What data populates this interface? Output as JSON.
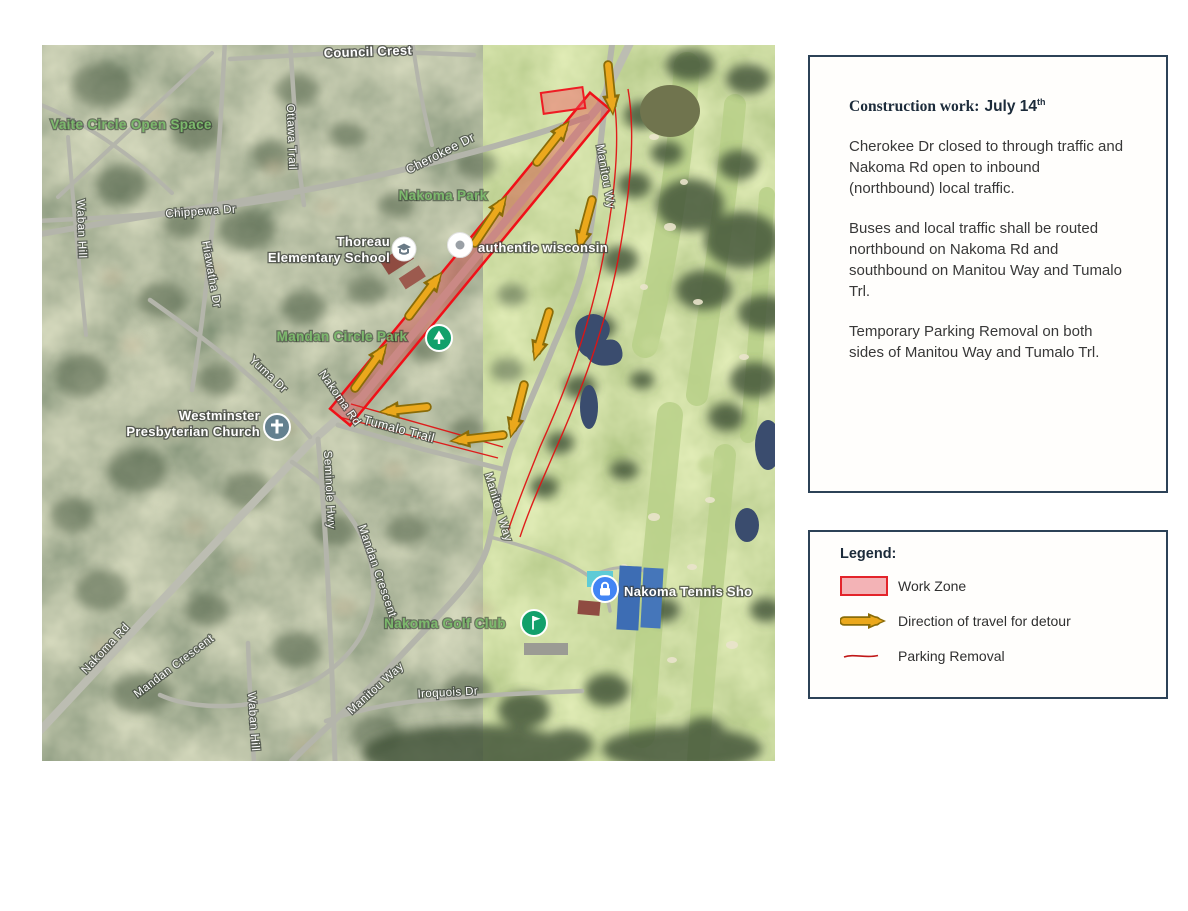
{
  "map": {
    "labels": {
      "council_crest": "Council Crest",
      "vaite_circle": "Vaite Circle Open Space",
      "ottawa_trail": "Ottawa Trail",
      "chippewa_dr": "Chippewa Dr",
      "waban_hill_left": "Waban Hill",
      "hiawatha_dr": "Hiawatha Dr",
      "cherokee_dr": "Cherokee Dr",
      "nakoma_park": "Nakoma Park",
      "thoreau_line1": "Thoreau",
      "thoreau_line2": "Elementary School",
      "authentic_wisconsin": "authentic wisconsin",
      "manitou_way_top": "Manitou Wy",
      "mandan_circle_park": "Mandan Circle Park",
      "yuma_dr": "Yuma Dr",
      "nakoma_rd_mid": "Nakoma Rd",
      "tumalo_trail": "Tumalo Trail",
      "westminster_line1": "Westminster",
      "westminster_line2": "Presbyterian Church",
      "seminole_hwy": "Seminole Hwy",
      "mandan_crescent_right": "Mandan Crescent",
      "mandan_crescent_left": "Mandan Crescent",
      "manitou_way_mid": "Manitou Way",
      "nakoma_golf_club": "Nakoma Golf Club",
      "nakoma_tennis": "Nakoma Tennis Sho",
      "manitou_way_bottom": "Manitou Way",
      "nakoma_rd_bottom": "Nakoma Rd",
      "waban_hill_bottom": "Waban Hill",
      "iroquois_dr": "Iroquois Dr"
    },
    "icons": [
      "school-icon",
      "place-pin-icon",
      "church-icon",
      "park-icon",
      "golf-icon",
      "lock-icon"
    ]
  },
  "info_panel": {
    "title_label": "Construction work:",
    "title_date": "July 14",
    "title_sup": "th",
    "paragraphs": [
      "Cherokee Dr closed to through traffic and Nakoma Rd open to inbound (northbound) local traffic.",
      "Buses and local traffic shall be routed northbound on Nakoma Rd and southbound on Manitou Way and Tumalo Trl.",
      "Temporary Parking Removal on both sides of Manitou Way and Tumalo Trl."
    ]
  },
  "legend": {
    "title": "Legend:",
    "items": [
      {
        "label": "Work Zone",
        "swatch": "work-zone"
      },
      {
        "label": "Direction of travel for detour",
        "swatch": "detour-arrow"
      },
      {
        "label": "Parking Removal",
        "swatch": "parking-line"
      }
    ]
  },
  "colors": {
    "work_zone_fill": "#f3b3b6",
    "work_zone_border": "#e3242b",
    "detour_arrow_fill": "#eba81c",
    "detour_arrow_outline": "#8a6c08",
    "parking_line": "#d01414",
    "panel_border": "#2c4257",
    "park_label_green": "#7cb96c"
  }
}
